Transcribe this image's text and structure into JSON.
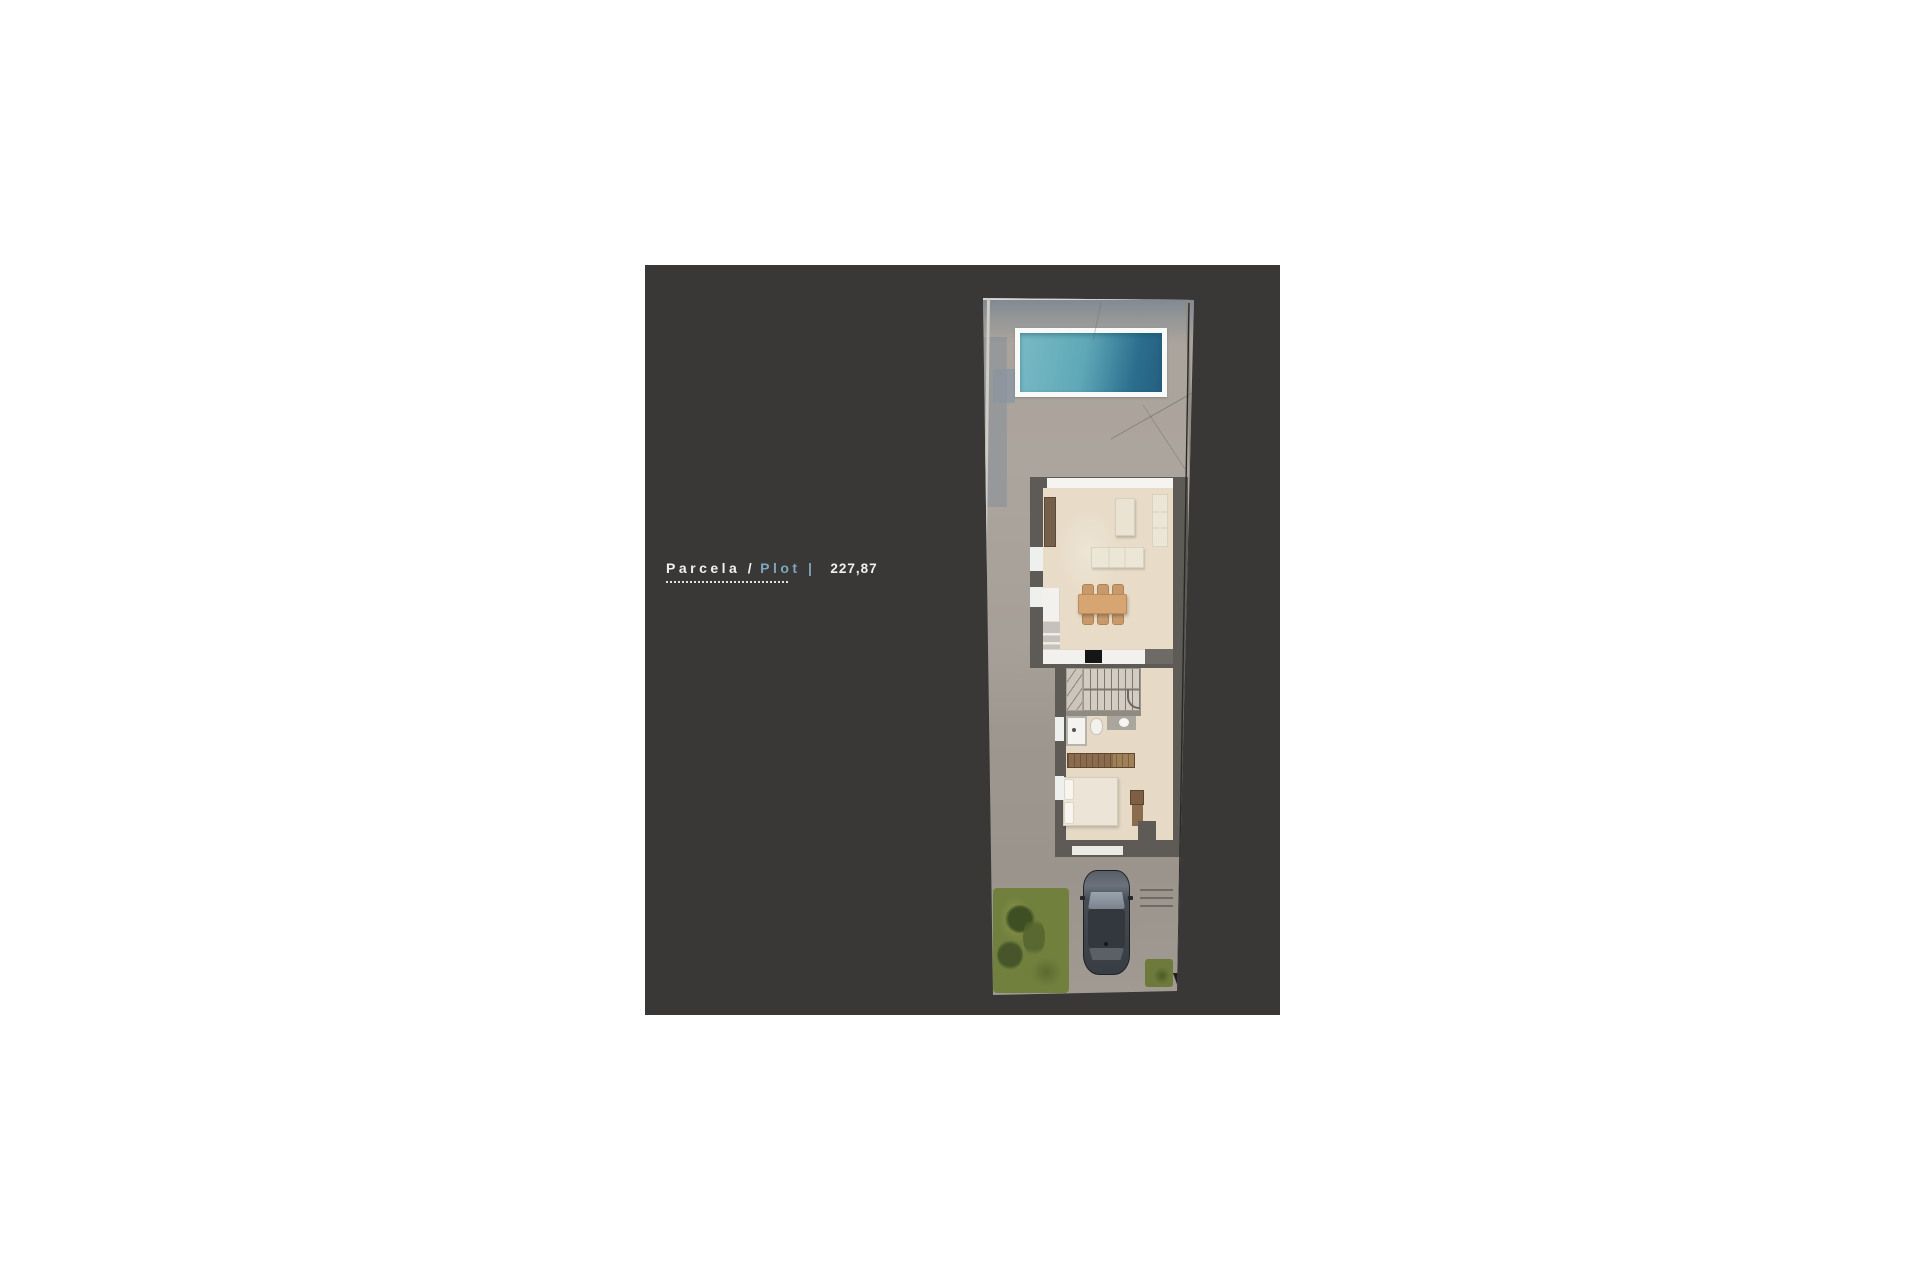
{
  "panel": {
    "background": "#393837"
  },
  "label": {
    "primary": "Parcela /",
    "secondary": "Plot |",
    "value": "227,87"
  },
  "colors": {
    "panel_bg": "#393837",
    "accent_blue": "#7fa6ba",
    "text_white": "#f1f1f1",
    "pool_frame": "#f7faf9",
    "pool_water_light": "#79bac4",
    "pool_water_dark": "#2b6e8d",
    "concrete": "#a9a29a",
    "shade_blue": "#7d8a98",
    "wall_dark": "#5e5a55",
    "floor_beige": "#e8dcc8",
    "cream": "#ece6d7",
    "wood_tan": "#d6a572",
    "wood_brown": "#8a6b4d",
    "white_trim": "#f2f1ed",
    "car_body": "#41464d",
    "car_glass": "#9aa4ae",
    "grass": "#72803e",
    "grass_dark": "#46562a",
    "ink": "#22211f"
  },
  "site_plan": {
    "features": [
      "boundary-wall",
      "swimming-pool",
      "concrete-deck",
      "house-floor-plan",
      "living-room-sofas",
      "coffee-table",
      "dining-table-six-chairs",
      "kitchen-counters",
      "fridge",
      "stove",
      "staircase",
      "bathroom-shower",
      "toilet",
      "vanity-basin",
      "wardrobe",
      "double-bed",
      "desk",
      "driveway",
      "parked-car",
      "lawn",
      "drain-grate",
      "dimension-arrow"
    ]
  }
}
